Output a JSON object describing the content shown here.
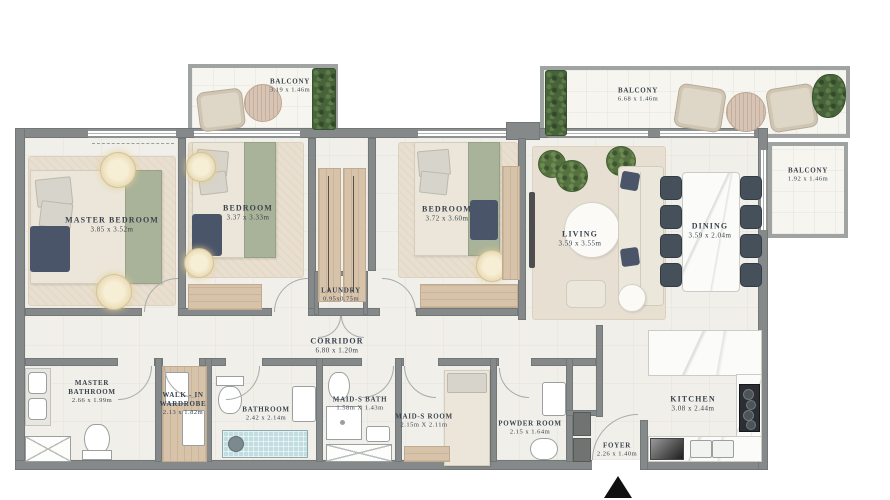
{
  "plan": {
    "title": "apartment-floor-plan",
    "rooms": {
      "master_bedroom": {
        "name": "MASTER BEDROOM",
        "dims": "3.85 x 3.52m"
      },
      "bedroom_2": {
        "name": "BEDROOM",
        "dims": "3.37 x 3.33m"
      },
      "bedroom_3": {
        "name": "BEDROOM",
        "dims": "3.72 x 3.60m"
      },
      "living": {
        "name": "LIVING",
        "dims": "3.59 x 3.55m"
      },
      "dining": {
        "name": "DINING",
        "dims": "3.59 x 2.04m"
      },
      "kitchen": {
        "name": "KITCHEN",
        "dims": "3.08 x 2.44m"
      },
      "balcony_top_left": {
        "name": "BALCONY",
        "dims": "3.19 x 1.46m"
      },
      "balcony_top_right": {
        "name": "BALCONY",
        "dims": "6.68 x 1.46m"
      },
      "balcony_right": {
        "name": "BALCONY",
        "dims": "1.92 x 1.46m"
      },
      "laundry": {
        "name": "LAUNDRY",
        "dims": "0.95x0.75m"
      },
      "corridor": {
        "name": "CORRIDOR",
        "dims": "6.80 x 1.20m"
      },
      "master_bathroom": {
        "name": "MASTER BATHROOM",
        "dims": "2.66 x 1.99m"
      },
      "walk_in_wardrobe": {
        "name": "WALK - IN WARDROBE",
        "dims": "2.13 x 1.82m"
      },
      "bathroom": {
        "name": "BATHROOM",
        "dims": "2.42 x 2.14m"
      },
      "maids_bath": {
        "name": "MAID-S BATH",
        "dims": "1.58m X 1.43m"
      },
      "maids_room": {
        "name": "MAID-S ROOM",
        "dims": "2.15m X 2.11m"
      },
      "powder_room": {
        "name": "POWDER ROOM",
        "dims": "2.15 x 1.64m"
      },
      "foyer": {
        "name": "FOYER",
        "dims": "2.26 x 1.40m"
      }
    },
    "colors": {
      "wall": "#85898a",
      "floor": "#f1efe9",
      "wood": "#d7c3aa",
      "greenery": "#46633a",
      "bed_green": "#a9b39a",
      "navy_accent": "#4b5569",
      "dining_chair": "#45505a",
      "tub_blue": "#c2dde2",
      "label_text": "#39434e"
    },
    "icons": {
      "entry_arrow": "entry-arrow"
    }
  }
}
